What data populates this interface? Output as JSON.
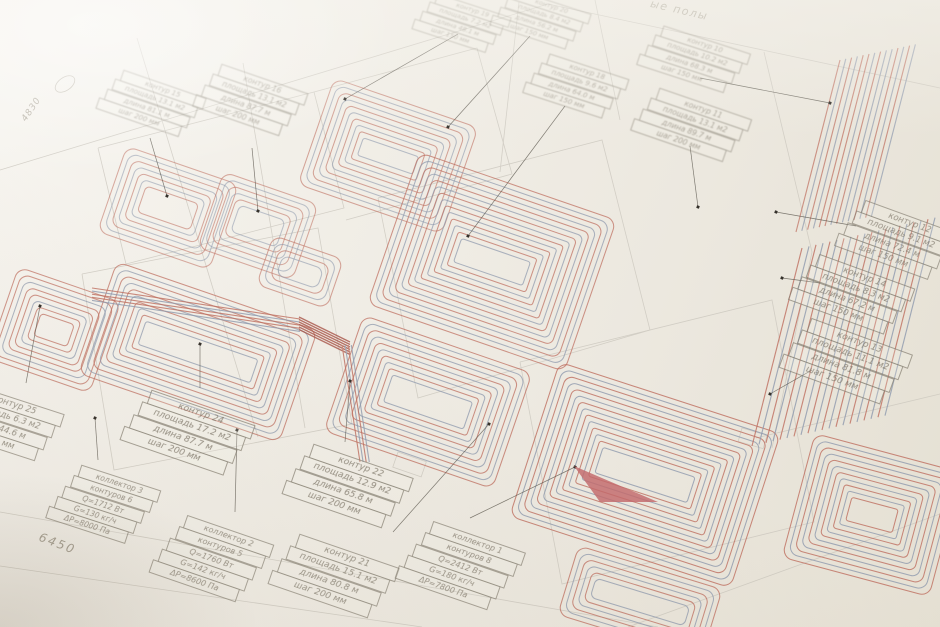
{
  "annotations": {
    "title_partial": "ые полы",
    "dim_4830": "4830",
    "dim_6450": "6450"
  },
  "colors": {
    "paper": "#f0ede6",
    "wall_line": "#c9c5bc",
    "table_line": "#7d776a",
    "text": "#847d70",
    "faded_text": "#a7a194",
    "pipe_red": "#bf6f60",
    "pipe_red_dark": "#a85448",
    "pipe_blue": "#8f9aae",
    "wedge_red": "#c3696b",
    "marker_dot": "#35312b"
  },
  "contour_tables": [
    {
      "id": "k15",
      "rows": [
        "контур 15",
        "площадь 13.1 м2",
        "длина 81.1 м",
        "шаг 200 мм"
      ]
    },
    {
      "id": "k16",
      "rows": [
        "контур 16",
        "площадь 13.1 м2",
        "длина 87.7 м",
        "шаг 200 мм"
      ]
    },
    {
      "id": "k19",
      "rows": [
        "контур 19",
        "площадь 7.2 м2",
        "длина 48.1 м",
        "шаг 150 мм"
      ]
    },
    {
      "id": "k20",
      "rows": [
        "контур 20",
        "площадь 8.4 м2",
        "длина 56.2 м",
        "шаг 150 мм"
      ]
    },
    {
      "id": "k18",
      "rows": [
        "контур 18",
        "площадь 9.6 м2",
        "длина 64.0 м",
        "шаг 150 мм"
      ]
    },
    {
      "id": "k10",
      "rows": [
        "контур 10",
        "площадь 10.2 м2",
        "длина 68.3 м",
        "шаг 150 мм"
      ]
    },
    {
      "id": "k11",
      "rows": [
        "контур 11",
        "площадь 13.1 м2",
        "длина 89.7 м",
        "шаг 200 мм"
      ]
    },
    {
      "id": "k12",
      "rows": [
        "контур 12",
        "площадь 9.1 м2",
        "длина 72.4 м",
        "шаг 150 мм"
      ]
    },
    {
      "id": "k14",
      "rows": [
        "контур 14",
        "площадь 8.3 м2",
        "длина 67.2 м",
        "шаг 150 мм"
      ]
    },
    {
      "id": "k13",
      "rows": [
        "контур 13",
        "площадь 11.1 м2",
        "длина 81.8 м",
        "шаг 150 мм"
      ]
    },
    {
      "id": "k25",
      "rows": [
        "контур 25",
        "площадь 6.3 м2",
        "длина 44.6 м",
        "шаг 150 мм"
      ]
    },
    {
      "id": "k24",
      "rows": [
        "контур 24",
        "площадь 17.2 м2",
        "длина 87.7 м",
        "шаг 200 мм"
      ]
    },
    {
      "id": "k22",
      "rows": [
        "контур 22",
        "площадь 12.9 м2",
        "длина 65.8 м",
        "шаг 200 мм"
      ]
    },
    {
      "id": "k21",
      "rows": [
        "контур 21",
        "площадь 15.1 м2",
        "длина 80.8 м",
        "шаг 200 мм"
      ]
    }
  ],
  "collector_tables": [
    {
      "id": "c3",
      "rows": [
        "коллектор 3",
        "контуров 6",
        "Q=1712 Вт",
        "G=130 кг/ч",
        "ΔP=8000 Па"
      ]
    },
    {
      "id": "c2",
      "rows": [
        "коллектор 2",
        "контуров 5",
        "Q=1760 Вт",
        "G=142 кг/ч",
        "ΔP=8600 Па"
      ]
    },
    {
      "id": "c1",
      "rows": [
        "коллектор 1",
        "контуров 8",
        "Q=2412 Вт",
        "G=180 кг/ч",
        "ΔP=7800 Па"
      ]
    }
  ]
}
